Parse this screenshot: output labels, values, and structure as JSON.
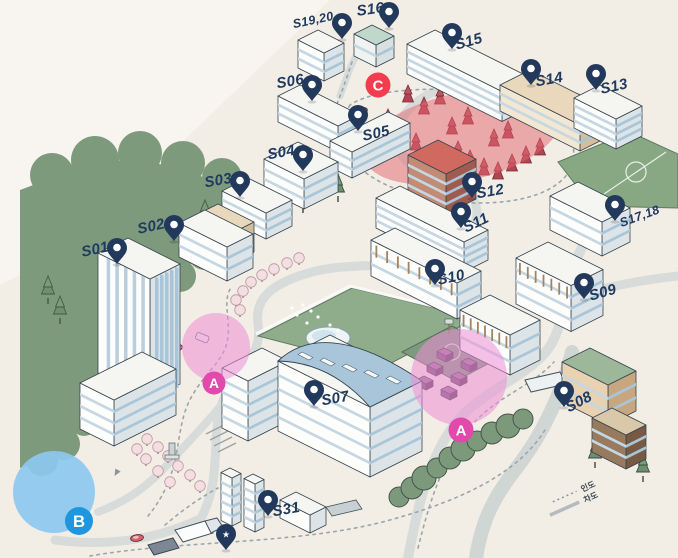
{
  "map": {
    "background_color": "#f2ede5",
    "pin_color": "#23395c",
    "label_color": "#1f3a5e",
    "pins": [
      {
        "label": "S01",
        "x": 117,
        "y": 264,
        "lx": 96,
        "ly": 254,
        "rot": -12
      },
      {
        "label": "S02",
        "x": 174,
        "y": 241,
        "lx": 152,
        "ly": 231,
        "rot": -12
      },
      {
        "label": "S03",
        "x": 240,
        "y": 197,
        "lx": 219,
        "ly": 185,
        "rot": -10
      },
      {
        "label": "S04",
        "x": 303,
        "y": 171,
        "lx": 282,
        "ly": 157,
        "rot": -10
      },
      {
        "label": "S05",
        "x": 358,
        "y": 131,
        "lx": 377,
        "ly": 138,
        "rot": -12
      },
      {
        "label": "S06",
        "x": 312,
        "y": 101,
        "lx": 291,
        "ly": 86,
        "rot": -10
      },
      {
        "label": "S07",
        "x": 314,
        "y": 406,
        "lx": 336,
        "ly": 403,
        "rot": -10
      },
      {
        "label": "S08",
        "x": 564,
        "y": 407,
        "lx": 581,
        "ly": 406,
        "rot": -28
      },
      {
        "label": "S09",
        "x": 584,
        "y": 299,
        "lx": 604,
        "ly": 297,
        "rot": -16
      },
      {
        "label": "S10",
        "x": 435,
        "y": 285,
        "lx": 452,
        "ly": 282,
        "rot": -12
      },
      {
        "label": "S11",
        "x": 461,
        "y": 228,
        "lx": 478,
        "ly": 227,
        "rot": -26
      },
      {
        "label": "S12",
        "x": 472,
        "y": 198,
        "lx": 491,
        "ly": 196,
        "rot": -10
      },
      {
        "label": "S13",
        "x": 596,
        "y": 90,
        "lx": 615,
        "ly": 91,
        "rot": -12
      },
      {
        "label": "S14",
        "x": 531,
        "y": 85,
        "lx": 550,
        "ly": 84,
        "rot": -10
      },
      {
        "label": "S15",
        "x": 452,
        "y": 49,
        "lx": 470,
        "ly": 46,
        "rot": -16
      },
      {
        "label": "S16",
        "x": 389,
        "y": 28,
        "lx": 371,
        "ly": 14,
        "rot": -8
      },
      {
        "label": "S17,18",
        "x": 615,
        "y": 221,
        "lx": 641,
        "ly": 220,
        "rot": -20
      },
      {
        "label": "S19,20",
        "x": 342,
        "y": 39,
        "lx": 314,
        "ly": 24,
        "rot": -12
      },
      {
        "label": "S31",
        "x": 268,
        "y": 516,
        "lx": 287,
        "ly": 514,
        "rot": -10
      },
      {
        "label": "",
        "x": 226,
        "y": 550,
        "lx": 226,
        "ly": 550,
        "rot": 0,
        "star": true
      }
    ],
    "badges": [
      {
        "letter": "A",
        "x": 214,
        "y": 383,
        "r": 11.5,
        "color": "#e149ab"
      },
      {
        "letter": "A",
        "x": 461,
        "y": 430,
        "r": 12.5,
        "color": "#e149ab"
      },
      {
        "letter": "B",
        "x": 79,
        "y": 521,
        "r": 14,
        "color": "#1e97de"
      },
      {
        "letter": "C",
        "x": 378,
        "y": 85,
        "r": 12.5,
        "color": "#f53b4d"
      }
    ],
    "overlays": [
      {
        "name": "zone-c",
        "shape": "ellipse",
        "x": 462,
        "y": 137,
        "rx": 100,
        "ry": 44,
        "rot": -12,
        "color": "#e4646e",
        "opacity": 0.5,
        "layer": "under"
      },
      {
        "name": "zone-a1",
        "shape": "circle",
        "x": 216,
        "y": 347,
        "r": 34,
        "color": "#ee8ed6",
        "opacity": 0.55,
        "layer": "over"
      },
      {
        "name": "zone-a2",
        "shape": "circle",
        "x": 459,
        "y": 377,
        "r": 48,
        "color": "#ee8ed6",
        "opacity": 0.55,
        "layer": "over"
      },
      {
        "name": "zone-b",
        "shape": "circle",
        "x": 54,
        "y": 492,
        "r": 41,
        "color": "#8dc8ef",
        "opacity": 0.92,
        "layer": "over"
      }
    ],
    "legend": {
      "dotted_label": "인도",
      "solid_label": "차도"
    }
  }
}
